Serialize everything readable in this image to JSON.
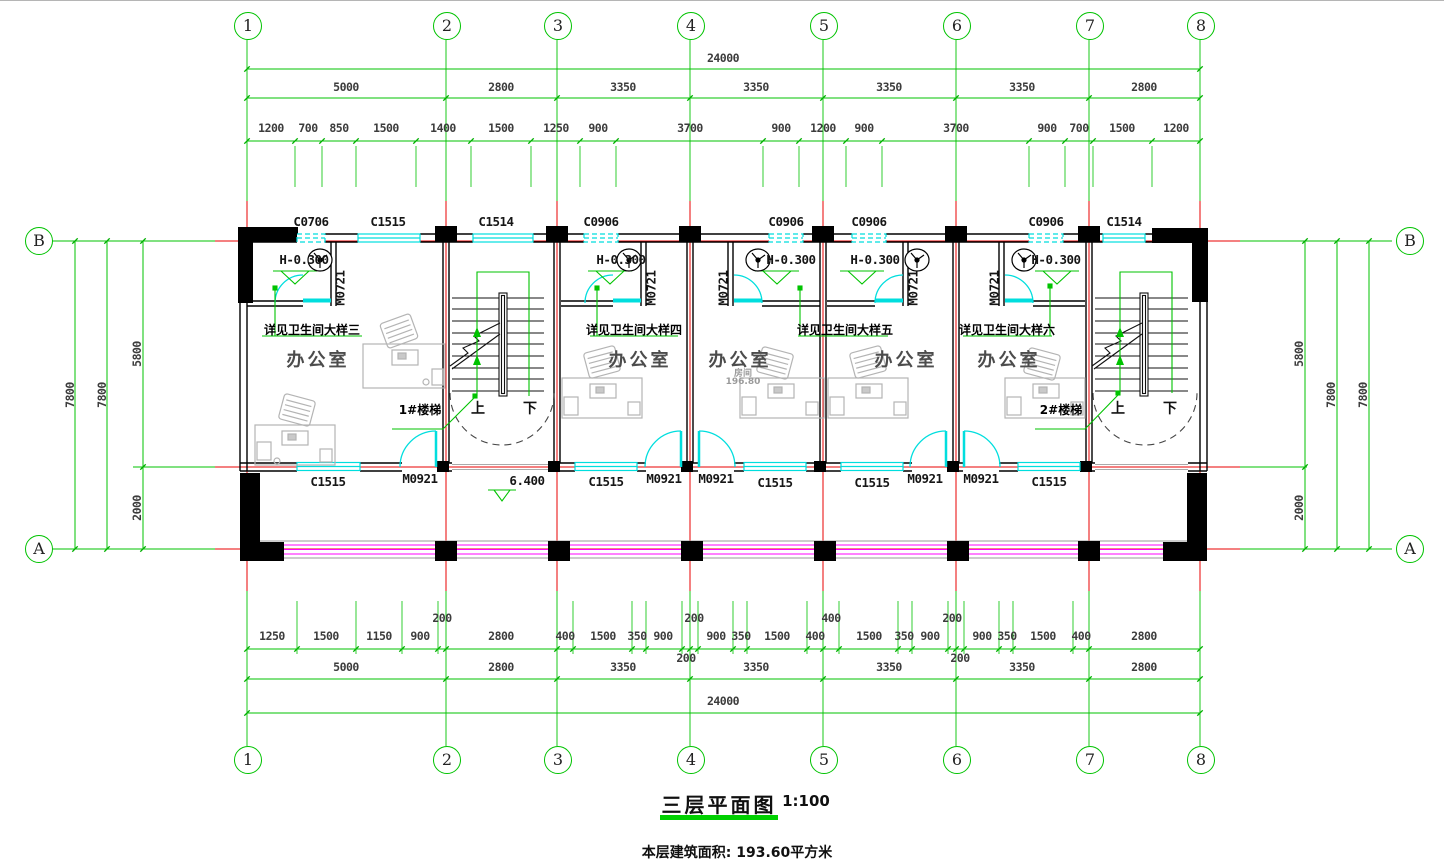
{
  "plan": {
    "title": "三层平面图",
    "scale": "1:100",
    "area_note": "本层建筑面积: 193.60平方米",
    "grid_cols": [
      "1",
      "2",
      "3",
      "4",
      "5",
      "6",
      "7",
      "8"
    ],
    "grid_rows": [
      "B",
      "A"
    ]
  },
  "dims": {
    "top_total": "24000",
    "top_spans": [
      "5000",
      "2800",
      "3350",
      "3350",
      "3350",
      "3350",
      "2800"
    ],
    "top_detail": [
      "1200",
      "700",
      "850",
      "1500",
      "1400",
      "1500",
      "1250",
      "900",
      "3700",
      "900",
      "1200",
      "900",
      "3700",
      "900",
      "700",
      "1500",
      "1200"
    ],
    "bottom_total": "24000",
    "bottom_spans": [
      "5000",
      "2800",
      "3350",
      "3350",
      "3350",
      "3350",
      "2800"
    ],
    "bottom_detail": [
      "1250",
      "1500",
      "1150",
      "900",
      "2800",
      "400",
      "1500",
      "350",
      "900",
      "900",
      "350",
      "1500",
      "400",
      "1500",
      "350",
      "900",
      "900",
      "350",
      "1500",
      "400",
      "2800"
    ],
    "bottom_offsets": {
      "g2_above": "200",
      "g4_above": "200",
      "g4_below": "200",
      "g5_above": "400",
      "g6_above": "200",
      "g6_below": "200"
    },
    "left": [
      "7800",
      "7800",
      "5800",
      "2000"
    ],
    "right": [
      "5800",
      "2000",
      "7800",
      "7800"
    ]
  },
  "openings": {
    "top_windows": [
      "C0706",
      "C1515",
      "C1514",
      "C0906",
      "C0906",
      "C0906",
      "C0906",
      "C1514"
    ],
    "bottom_windows": [
      "C1515",
      "C1515",
      "C1515",
      "C1515",
      "C1515"
    ],
    "bath_door": "M0721",
    "room_door": "M0921"
  },
  "rooms": {
    "office": "办公室",
    "bath_level": "H-0.300",
    "bath_notes": [
      "详见卫生间大样三",
      "详见卫生间大样四",
      "详见卫生间大样五",
      "详见卫生间大样六"
    ],
    "room_tag": "房间",
    "room_area": "196.80"
  },
  "stairs": {
    "s1": "1#楼梯",
    "s2": "2#楼梯",
    "up": "上",
    "down": "下",
    "landing_level": "6.400"
  },
  "colors": {
    "grid": "#00c300",
    "axis": "#e80000",
    "glazing": "#00dede",
    "railing": "#ff00ff",
    "wall": "#000000",
    "furniture": "#b4b4b4"
  }
}
